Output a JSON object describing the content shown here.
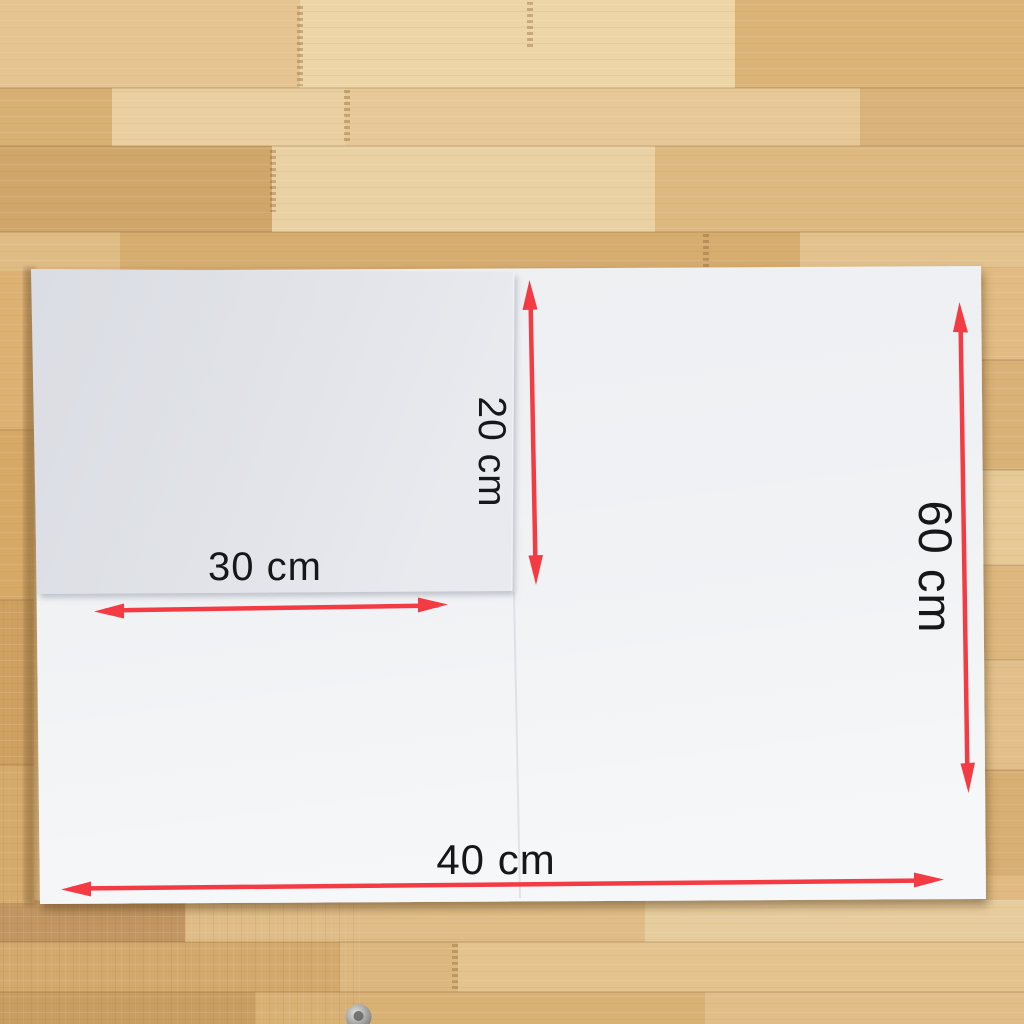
{
  "colors": {
    "arrow": "#f43b44",
    "label_text": "#17171a",
    "board_large": "#edeff2",
    "board_small": "#e5e7ec",
    "wood_base": "#dcb57e"
  },
  "dimension_labels": {
    "inner_height": "20 cm",
    "inner_width": "30 cm",
    "outer_height": "60 cm",
    "outer_width": "40 cm"
  }
}
